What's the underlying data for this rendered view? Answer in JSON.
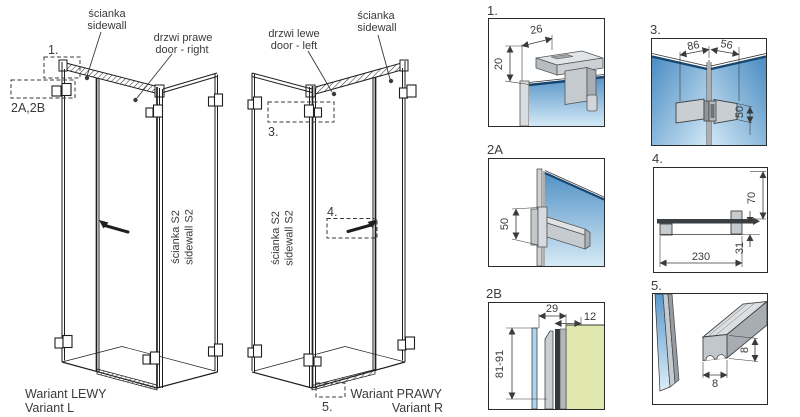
{
  "colors": {
    "glass_top": "#4a8cc2",
    "glass_bottom": "#d6eaf6",
    "glass_edge": "#17456e",
    "wall_green": "#e0e8b0",
    "profile_light": "#d8dcdf",
    "profile_mid": "#c6cbd0",
    "profile_dark": "#a0a6ab",
    "handle_dark": "#3a3f44",
    "line": "#1e1e1e",
    "text": "#3a3a3a"
  },
  "left_drawing": {
    "sidewall_label_1": "ścianka",
    "sidewall_label_2": "sidewall",
    "door_label_1": "drzwi prawe",
    "door_label_2": "door - right",
    "callout_1": "1.",
    "callout_2ab": "2A,2B",
    "s2_label_1": "ścianka S2",
    "s2_label_2": "sidewall S2",
    "variant_1": "Wariant LEWY",
    "variant_2": "Variant L"
  },
  "right_drawing": {
    "door_label_1": "drzwi lewe",
    "door_label_2": "door - left",
    "sidewall_label_1": "ścianka",
    "sidewall_label_2": "sidewall",
    "callout_3": "3.",
    "callout_4": "4.",
    "callout_5": "5.",
    "s2_label_1": "ścianka S2",
    "s2_label_2": "sidewall S2",
    "variant_1": "Wariant PRAWY",
    "variant_2": "Variant R"
  },
  "details": {
    "d1": {
      "label": "1.",
      "dims": {
        "width": "26",
        "drop": "20"
      }
    },
    "d3": {
      "label": "3.",
      "dims": {
        "left": "86",
        "right": "56",
        "height": "50"
      }
    },
    "d2a": {
      "label": "2A",
      "dims": {
        "height": "50"
      }
    },
    "d4": {
      "label": "4.",
      "dims": {
        "height": "70",
        "offset": "31",
        "length": "230"
      }
    },
    "d2b": {
      "label": "2B",
      "dims": {
        "top": "29",
        "side": "12",
        "range": "81-91"
      }
    },
    "d5": {
      "label": "5.",
      "dims": {
        "width": "8",
        "height": "8"
      }
    }
  }
}
